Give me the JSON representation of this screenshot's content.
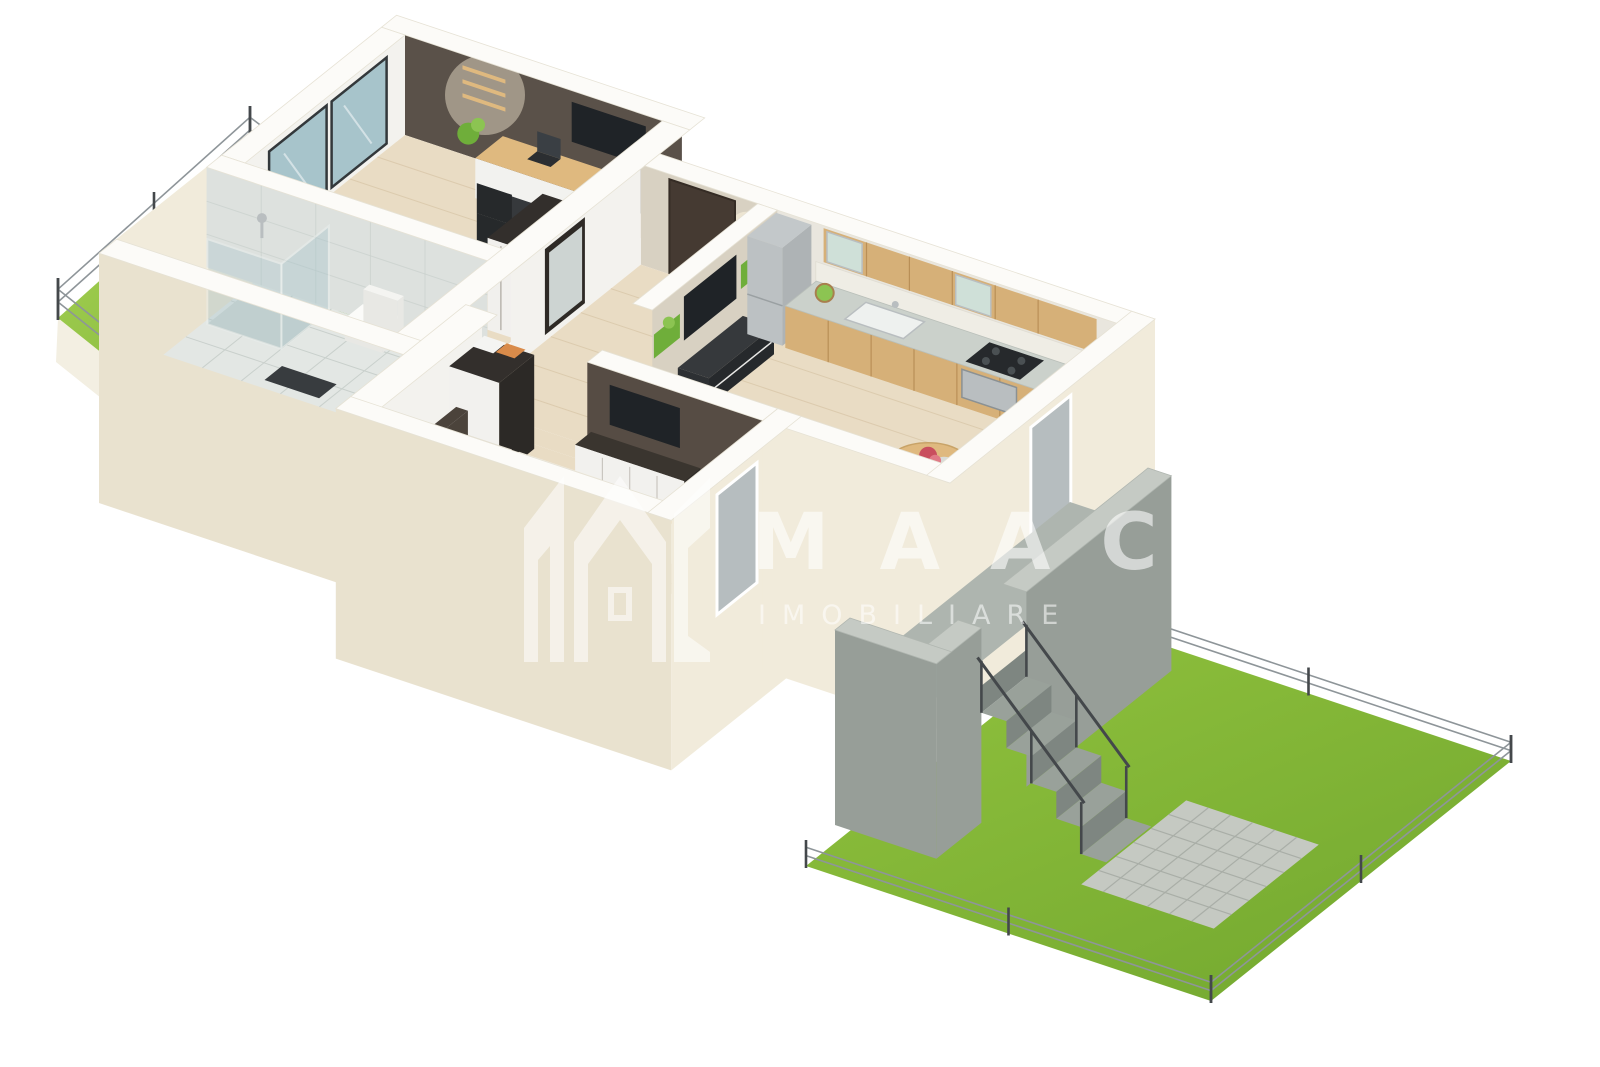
{
  "page": {
    "title": "3D Floor Plan Rendering",
    "background": "#ffffff"
  },
  "watermark": {
    "brand": "MAAC",
    "tagline": "IMOBILIARE",
    "logo_name": "maac-monogram-logo",
    "color": "rgba(255,255,255,0.55)"
  },
  "palette": {
    "background": "#ffffff",
    "lawn": "#92c33e",
    "lawn_light": "#a8d455",
    "lawn_dark": "#74a930",
    "fence_post": "#44484b",
    "fence_rail": "#8e9599",
    "plinth": "#f3efe2",
    "wall_top": "#fcfbf8",
    "wall_top_line": "#e6e2d5",
    "wall_outer": "#f1ebdb",
    "wall_outer_shade": "#e9e2cf",
    "wall_inner_white": "#f3f2ee",
    "accent_office": "#5a5149",
    "accent_bedroom": "#564c44",
    "texture_wall": "#d8d1c2",
    "kitchen_wall": "#e9e6de",
    "backsplash": "#efede5",
    "floor_wood": "#e9dcc4",
    "floor_plank": "#d9c7a9",
    "floor_tile": "#e3e7e4",
    "tile_line": "#c9d0cc",
    "tile_wall": "#dde1de",
    "glass": "#a7c4cb",
    "glass_dark": "#b6bdbf",
    "frame_dark": "#33383b",
    "tv": "#1f2327",
    "furniture_dark": "#36393c",
    "furniture_wood": "#dfb97f",
    "counter": "#cbd1cb",
    "cabinet_wood": "#d6b078",
    "cabinet_seam": "#b98f57",
    "steel": "#b9bec0",
    "door_wood": "#c79f66",
    "door_dark": "#453a32",
    "sofa": "#6d4a33",
    "sofa_dark": "#5e3f2b",
    "bed": "#f6f3ec",
    "bed_side": "#e9e4d8",
    "plant": "#6fae3a",
    "plant_light": "#8cc452",
    "terrace_floor": "#aeb5af",
    "parapet_top": "#c5cac4",
    "parapet_face": "#979e98",
    "step": "#99a19a",
    "step_riser": "#7e8681",
    "patio": "#c5c9c2",
    "patio_line": "#a9aea7",
    "flower": "#c94f5e",
    "white": "#ffffff"
  },
  "scene": {
    "type": "isometric-3d-floor-plan",
    "rooms": [
      {
        "name": "office-bedroom",
        "floor": "light-wood",
        "features": [
          "glass-patio-door",
          "wall-shelves",
          "desk-with-laptop",
          "office-chair",
          "tv",
          "dresser",
          "wardrobe",
          "rug",
          "plant"
        ]
      },
      {
        "name": "bathroom",
        "floor": "grey-tile",
        "features": [
          "glass-shower",
          "toilet",
          "bath-mat",
          "wooden-door"
        ]
      },
      {
        "name": "entry-hall",
        "floor": "light-wood",
        "features": [
          "entrance-door",
          "mirror",
          "spotlights"
        ]
      },
      {
        "name": "kitchen-living-room",
        "floor": "light-wood",
        "features": [
          "fridge",
          "kitchen-cabinets",
          "counter-with-sink",
          "gas-hob",
          "oven",
          "upper-cabinets",
          "backsplash",
          "dining-table-with-flowers",
          "dining-chairs",
          "sofa",
          "tv-wall-with-plants",
          "tv-stand"
        ]
      },
      {
        "name": "bedroom",
        "floor": "light-wood",
        "features": [
          "bed",
          "headboard",
          "tv",
          "dresser",
          "wardrobe",
          "desk-with-laptop",
          "window"
        ]
      }
    ],
    "exterior": [
      {
        "name": "left-garden",
        "features": [
          "lawn",
          "wire-fence"
        ]
      },
      {
        "name": "right-garden",
        "features": [
          "lawn",
          "wire-fence",
          "paved-patio"
        ]
      },
      {
        "name": "terrace",
        "features": [
          "concrete-parapet",
          "stairs",
          "railing"
        ]
      }
    ]
  }
}
